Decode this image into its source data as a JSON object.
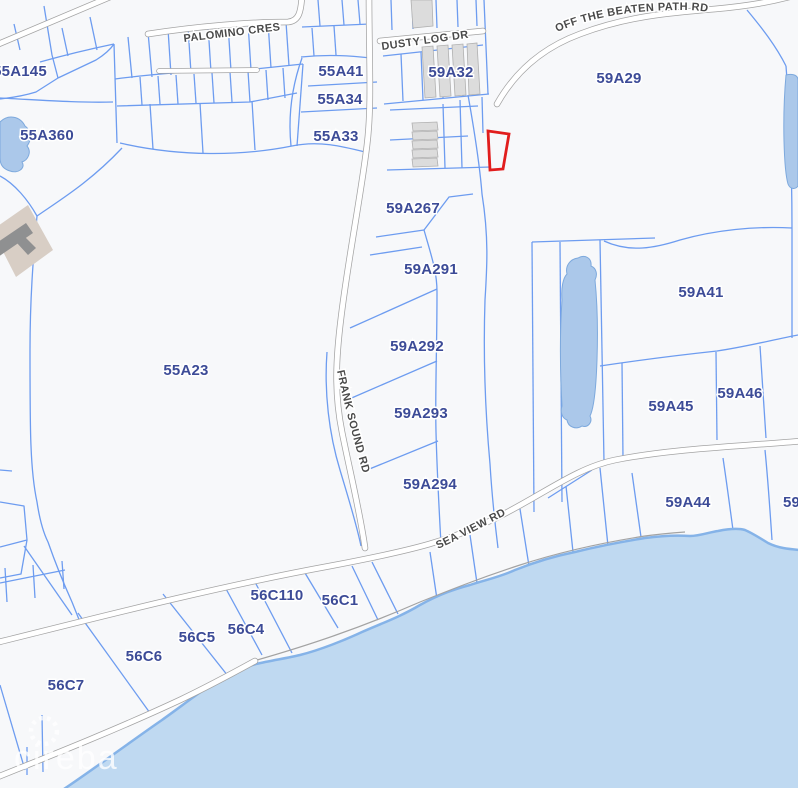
{
  "parcel_labels": [
    "55A145",
    "55A360",
    "55A41",
    "55A34",
    "55A33",
    "59A32",
    "59A29",
    "59A267",
    "59A291",
    "59A292",
    "59A293",
    "59A294",
    "55A23",
    "59A41",
    "59A45",
    "59A46",
    "59A44",
    "59A",
    "56C110",
    "56C1",
    "56C5",
    "56C4",
    "56C6",
    "56C7"
  ],
  "road_labels": {
    "palomino": "PALOMINO CRES",
    "dusty_log": "DUSTY LOG DR",
    "off_the_beaten_path": "OFF THE BEATEN PATH RD",
    "frank_sound": "FRANK SOUND RD",
    "sea_view": "SEA VIEW RD"
  },
  "watermark": {
    "text": "cireba"
  },
  "colors": {
    "land": "#f7f8fa",
    "parcel_line": "#6d9cf0",
    "parcel_label": "#3c4b97",
    "road_casing": "#a3a3a3",
    "road_fill": "#ffffff",
    "road_label": "#4a4a4a",
    "highlight": "#e11d1d",
    "water": "#bfd9f1",
    "shoreline": "#85b3e8",
    "pond": "#abc8ea",
    "pond_edge": "#7da9dd",
    "building": "#dcdcdc",
    "building_edge": "#b0b0b0",
    "site_tan": "#d8cec5",
    "structure_gray": "#8f9091",
    "watermark": "#ffffff"
  }
}
